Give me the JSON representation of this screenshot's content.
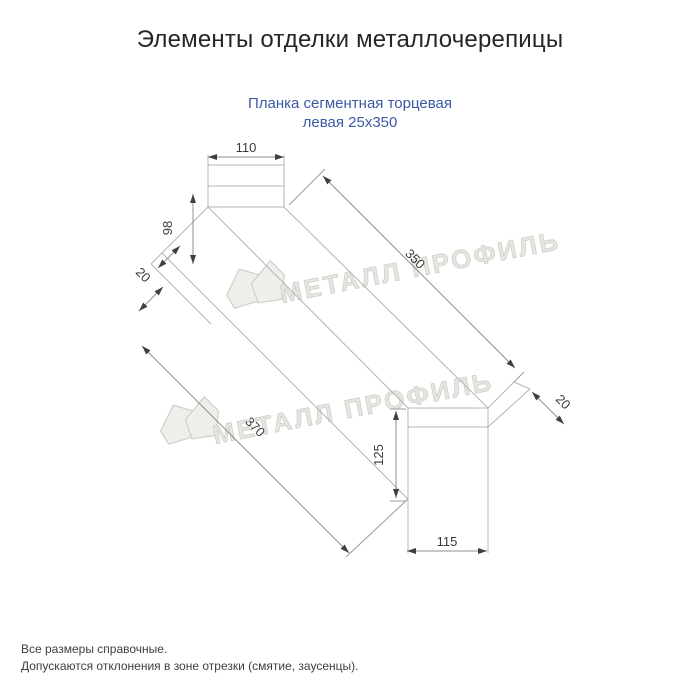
{
  "header": {
    "title": "Элементы отделки металлочерепицы",
    "subtitle_line1": "Планка сегментная торцевая",
    "subtitle_line2": "левая 25х350"
  },
  "drawing": {
    "type": "dimensioned technical drawing of metal end strip, oblique projection",
    "dims": {
      "top_width": "110",
      "left_web": "98",
      "left_hem": "20",
      "length_top": "350",
      "right_hem": "20",
      "right_height": "125",
      "bottom_width": "115",
      "length_bottom": "370"
    },
    "watermark": {
      "text": "МЕТАЛЛ ПРОФИЛЬ",
      "logo": "metall-profil-house-logo"
    },
    "colors": {
      "part_line": "#b4b4b4",
      "dim_line": "#8f8f8f",
      "dim_text": "#3a3a3a",
      "watermark": "#dedbd3"
    }
  },
  "notes": {
    "line1": "Все размеры справочные.",
    "line2": "Допускаются отклонения в зоне отрезки (смятие, заусенцы)."
  },
  "colors": {
    "background": "#ffffff",
    "title": "#262626",
    "subtitle": "#3c59a6",
    "notes": "#3e3e3e"
  }
}
